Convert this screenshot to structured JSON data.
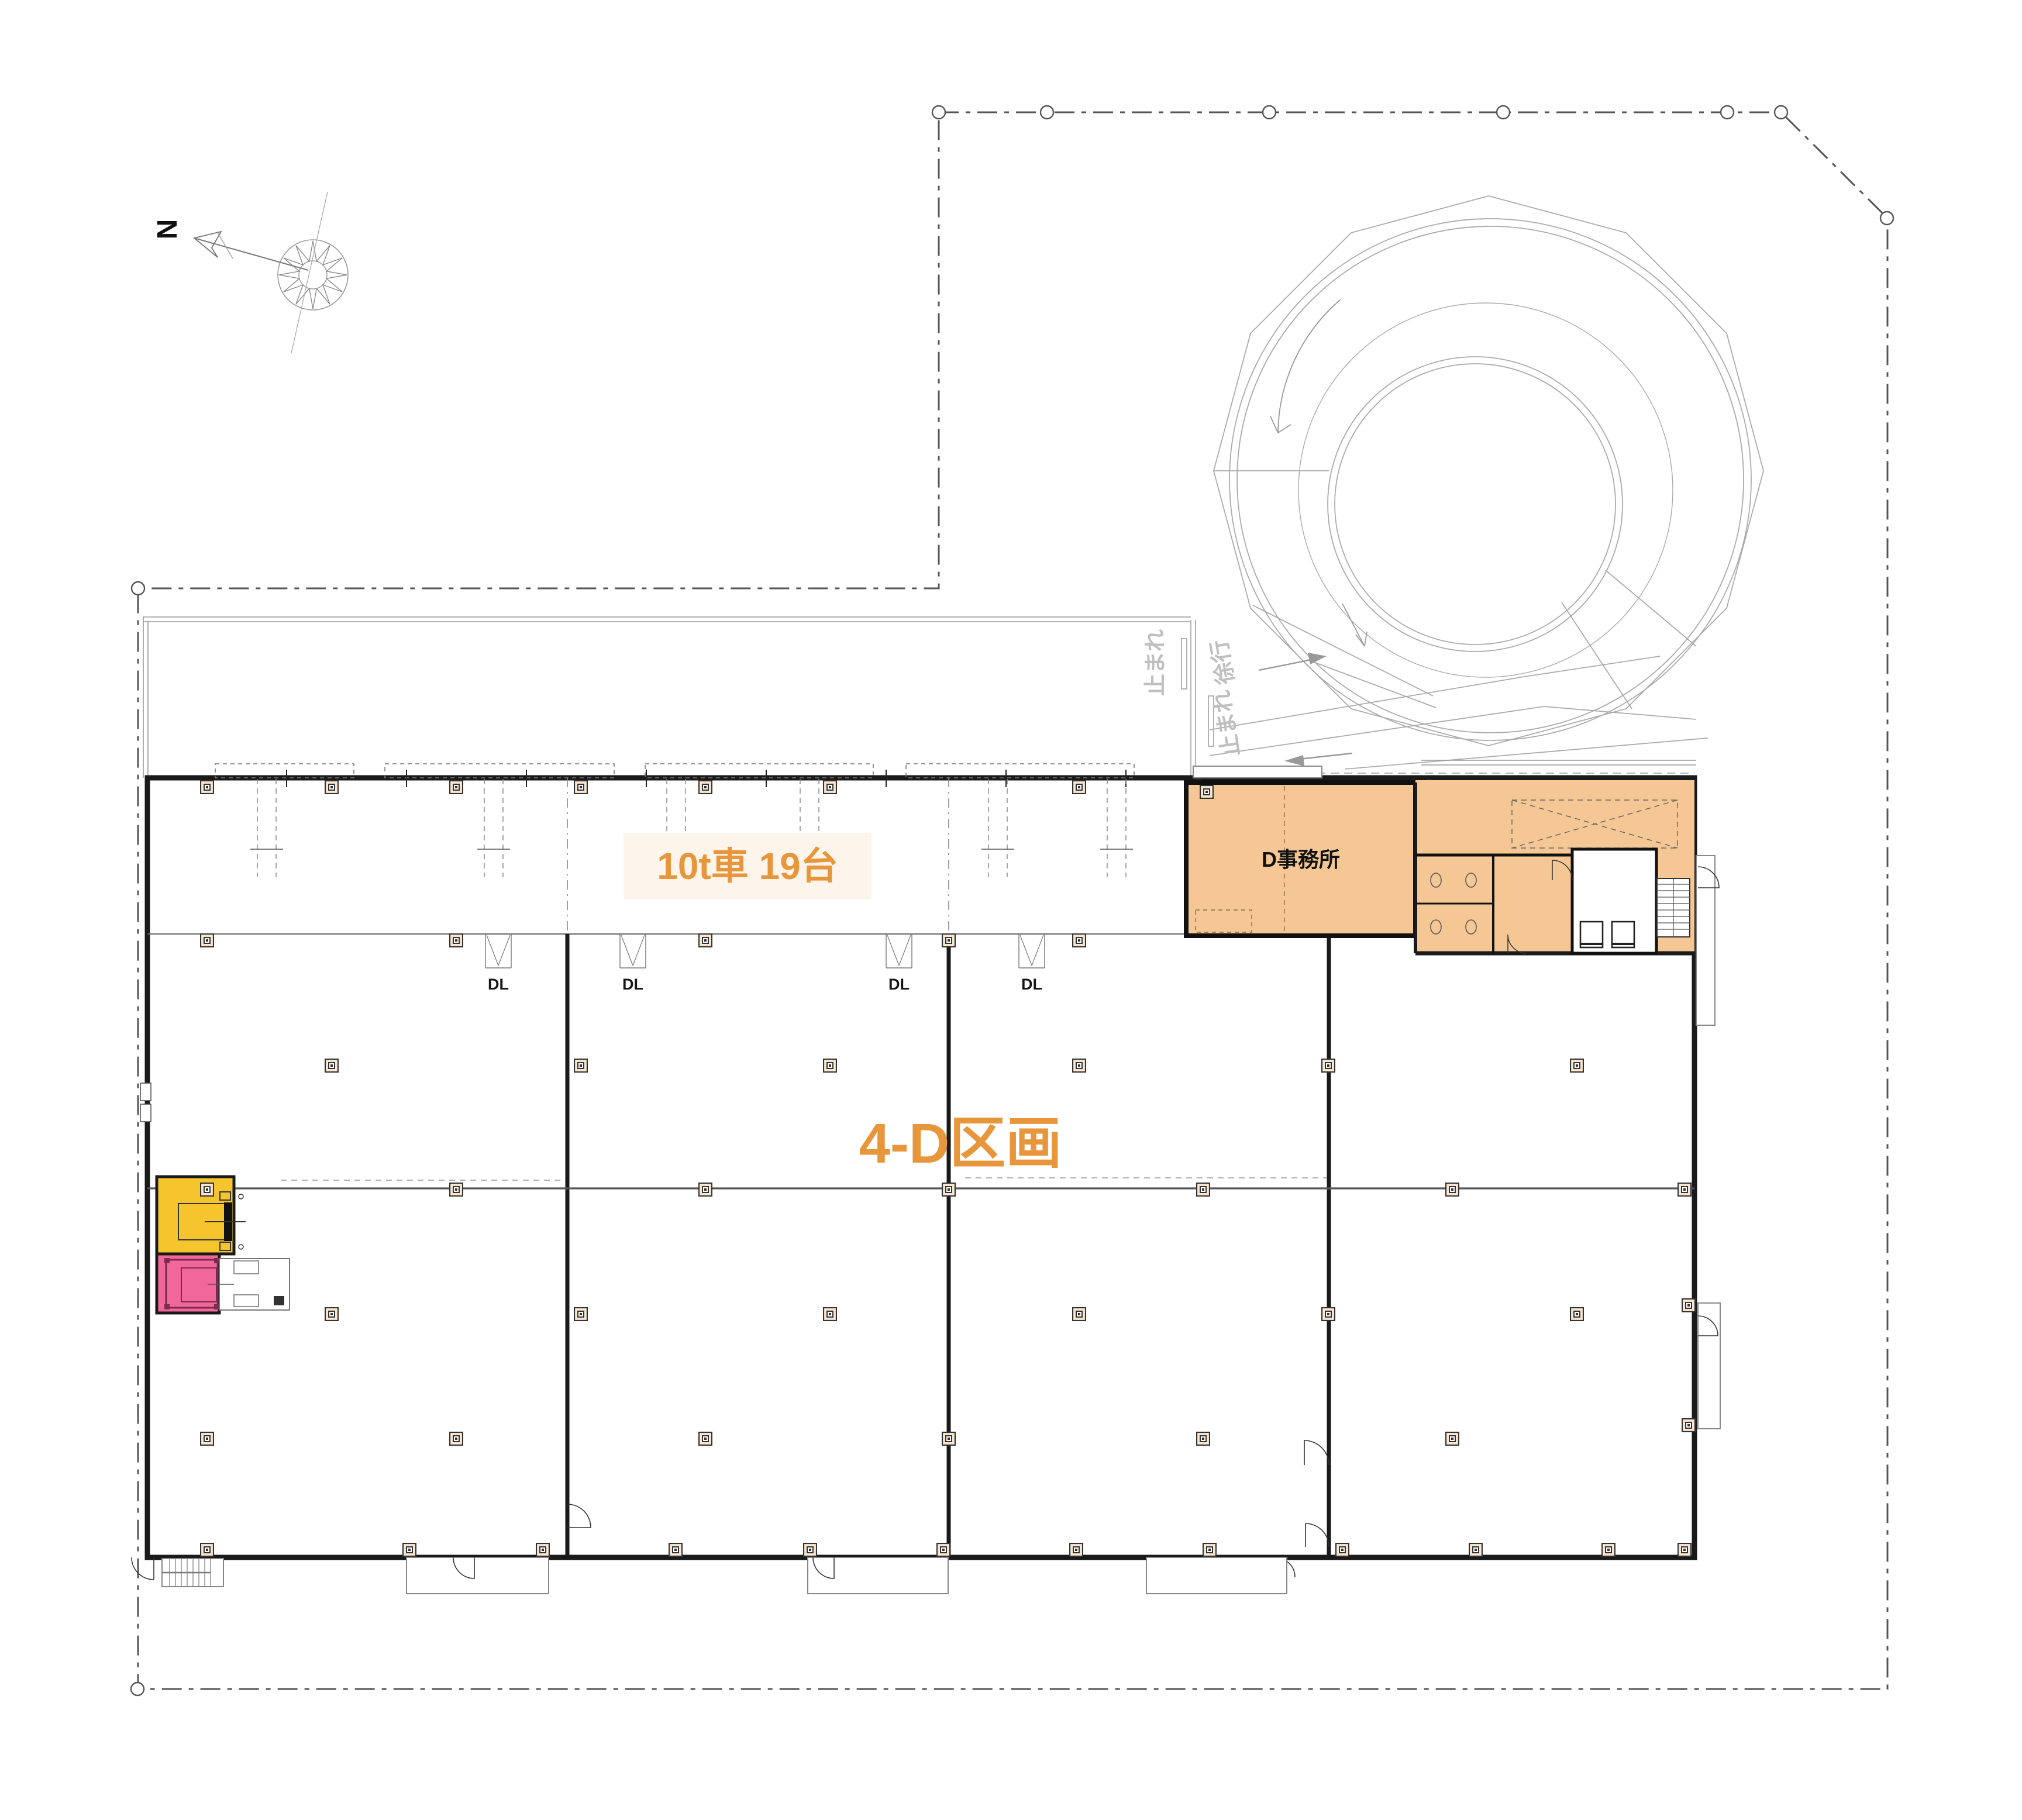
{
  "drawing": {
    "compass": {
      "north_label": "N"
    },
    "site": {
      "boundary_style": "dash-dot property line with vertex circles"
    },
    "building": {
      "zone_label": "4-D区画",
      "truck_berth_label": "10t車 19台",
      "office_label": "D事務所",
      "dock_leveler_label": "DL",
      "dock_leveler_count": 4
    },
    "ramp": {
      "slow_label": "徐行",
      "stop_label": "止まれ"
    },
    "colors": {
      "floor": "#FAE7D1",
      "office": "#F5C794",
      "accent_orange": "#E8963C",
      "highlight_yellow": "#F6C52E",
      "highlight_pink": "#F2679B",
      "wall": "#1A1A1A",
      "line_gray": "#999999",
      "boundary": "#555555",
      "label_bg": "#FDF5EC"
    }
  }
}
